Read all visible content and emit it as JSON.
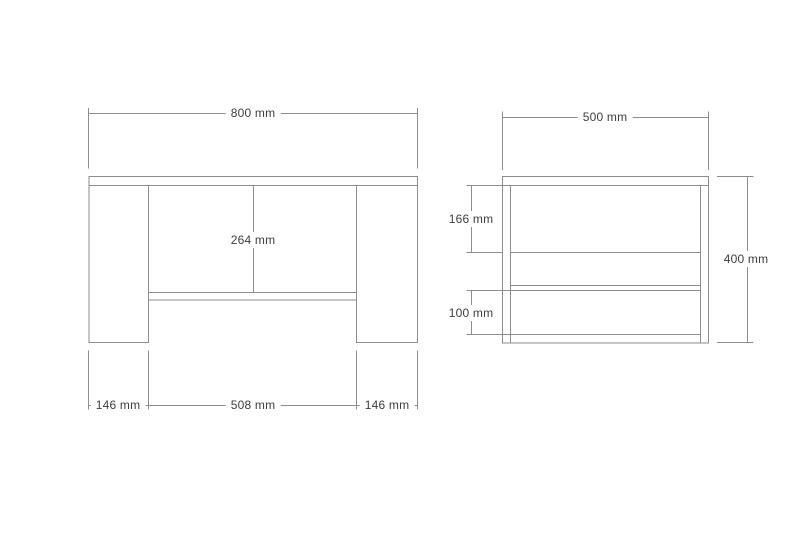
{
  "page": {
    "background": "#ffffff"
  },
  "drawing": {
    "line_color": "#8d8d8d",
    "text_color": "#3d3d3d",
    "unit": "mm",
    "front_view": {
      "name": "front view",
      "dims": {
        "overall_width": "800 mm",
        "leg_inner_height": "264 mm",
        "left_leg_width": "146 mm",
        "inner_span": "508 mm",
        "right_leg_width": "146 mm"
      }
    },
    "side_view": {
      "name": "side view",
      "dims": {
        "overall_depth": "500 mm",
        "upper_compartment": "166 mm",
        "lower_compartment": "100 mm",
        "overall_height": "400 mm"
      }
    }
  }
}
